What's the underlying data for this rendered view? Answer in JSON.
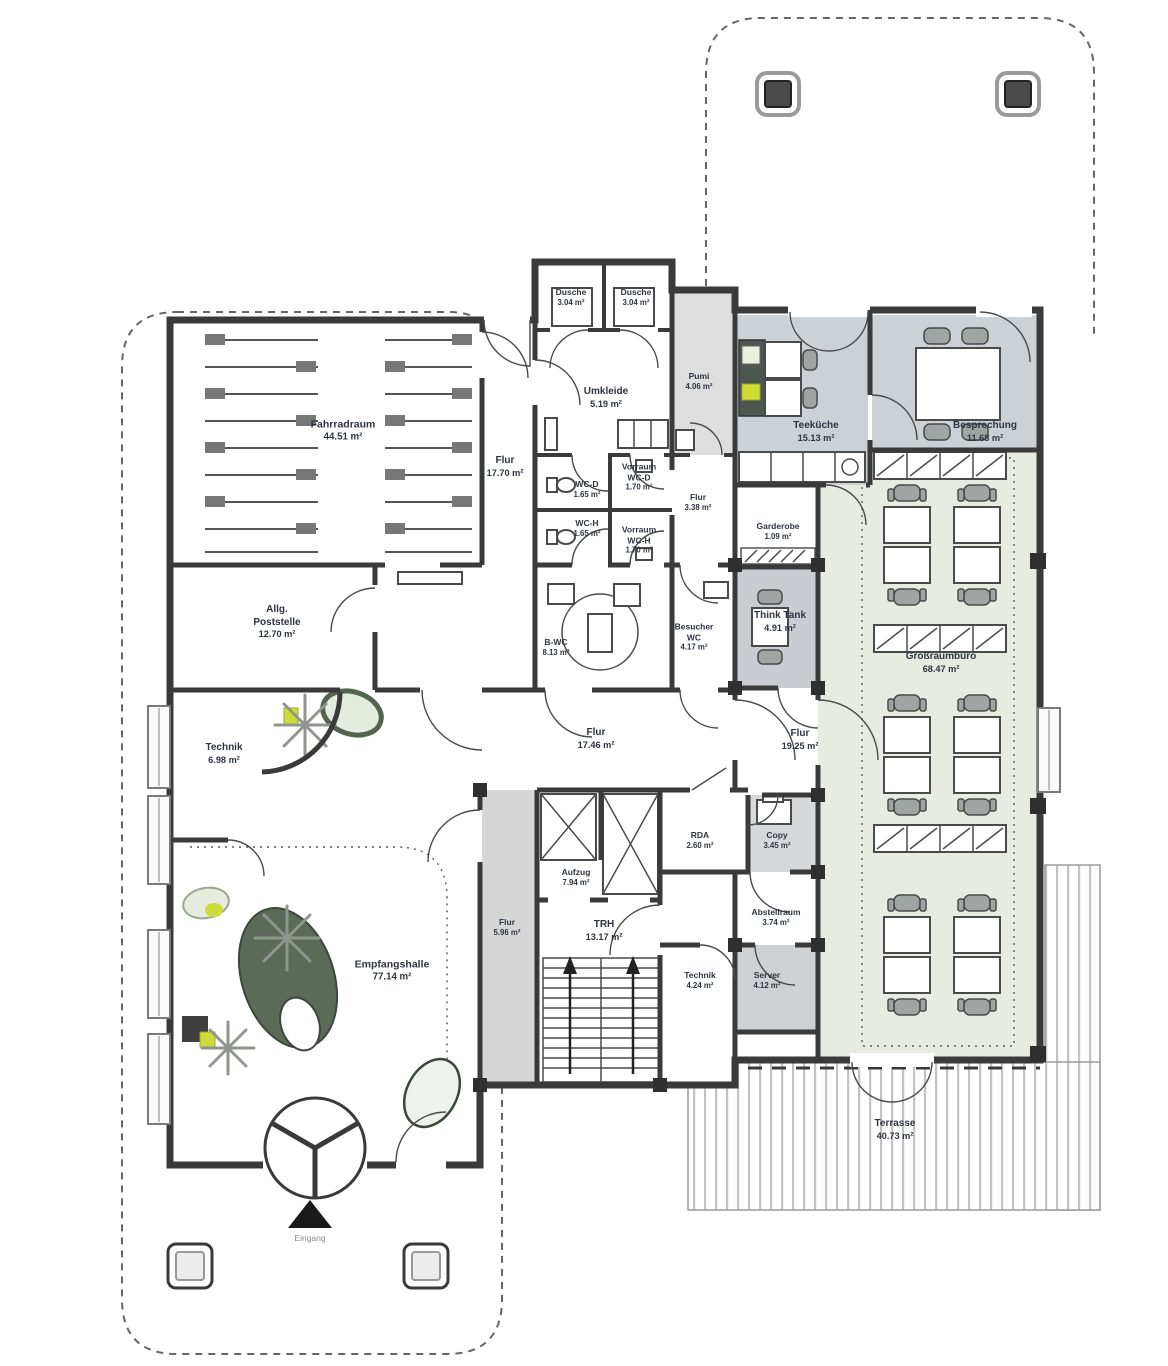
{
  "rooms": [
    {
      "name": "Fahrradraum",
      "area": "44.51 m²"
    },
    {
      "name": "Dusche",
      "area": "3.04 m²"
    },
    {
      "name": "Dusche",
      "area": "3.04 m²"
    },
    {
      "name": "Umkleide",
      "area": "5.19 m²"
    },
    {
      "name": "Pumi",
      "area": "4.06 m²"
    },
    {
      "name": "Flur",
      "area": "17.70 m²"
    },
    {
      "name": "WC-D",
      "area": "1.65 m²"
    },
    {
      "name": "Vorraum\nWC-D",
      "area": "1.70 m²"
    },
    {
      "name": "WC-H",
      "area": "1.65 m²"
    },
    {
      "name": "Vorraum\nWC-H",
      "area": "1.70 m²"
    },
    {
      "name": "Flur",
      "area": "3.38 m²"
    },
    {
      "name": "Teeküche",
      "area": "15.13 m²"
    },
    {
      "name": "Besprechung",
      "area": "11.68 m²"
    },
    {
      "name": "Garderobe",
      "area": "1.09 m²"
    },
    {
      "name": "Think Tank",
      "area": "4.91 m²"
    },
    {
      "name": "Allg.\nPoststelle",
      "area": "12.70 m²"
    },
    {
      "name": "B-WC",
      "area": "8.13 m²"
    },
    {
      "name": "Besucher\nWC",
      "area": "4.17 m²"
    },
    {
      "name": "Technik",
      "area": "6.98 m²"
    },
    {
      "name": "Flur",
      "area": "17.46 m²"
    },
    {
      "name": "Flur",
      "area": "19.25 m²"
    },
    {
      "name": "Großraumbüro",
      "area": "68.47 m²"
    },
    {
      "name": "RDA",
      "area": "2.60 m²"
    },
    {
      "name": "Copy",
      "area": "3.45 m²"
    },
    {
      "name": "Aufzug",
      "area": "7.94 m²"
    },
    {
      "name": "Flur",
      "area": "5.96 m²"
    },
    {
      "name": "TRH",
      "area": "13.17 m²"
    },
    {
      "name": "Technik",
      "area": "4.24 m²"
    },
    {
      "name": "Abstellraum",
      "area": "3.74 m²"
    },
    {
      "name": "Server",
      "area": "4.12 m²"
    },
    {
      "name": "Empfangshalle",
      "area": "77.14 m²"
    },
    {
      "name": "Terrasse",
      "area": "40.73 m²"
    }
  ],
  "entrance": {
    "label": "Eingang"
  },
  "colors": {
    "wall": "#3a3a3a",
    "room_gray": "#ccd1d5",
    "office_green": "#e7ece2",
    "accent_lime": "#cddc39",
    "plant_green": "#5c6b57",
    "text": "#2e3440"
  }
}
